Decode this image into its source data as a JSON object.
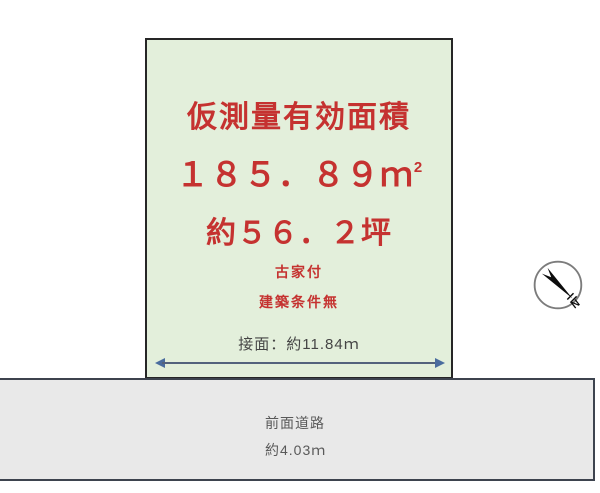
{
  "plot": {
    "title": "仮測量有効面積",
    "area_value": "１８５．８９",
    "area_unit": "ｍ",
    "area_unit_sup": "2",
    "tsubo_value": "約５６．２坪",
    "note_line1": "古家付",
    "note_line2": "建築条件無",
    "frontage_label": "接面：約11.84ｍ"
  },
  "road": {
    "name": "前面道路",
    "width_label": "約4.03ｍ"
  },
  "compass": {
    "icon": "north-arrow-icon",
    "label": "N"
  },
  "colors": {
    "plot_fill": "#e3efdb",
    "plot_border": "#262626",
    "highlight_red": "#c53230",
    "road_fill": "#e9e9e9",
    "road_border": "#3d434e",
    "dimension_arrow_blue": "#4a6c9e",
    "dimension_line": "#53627c",
    "label_gray": "#595959",
    "frontage_text": "#454545"
  }
}
